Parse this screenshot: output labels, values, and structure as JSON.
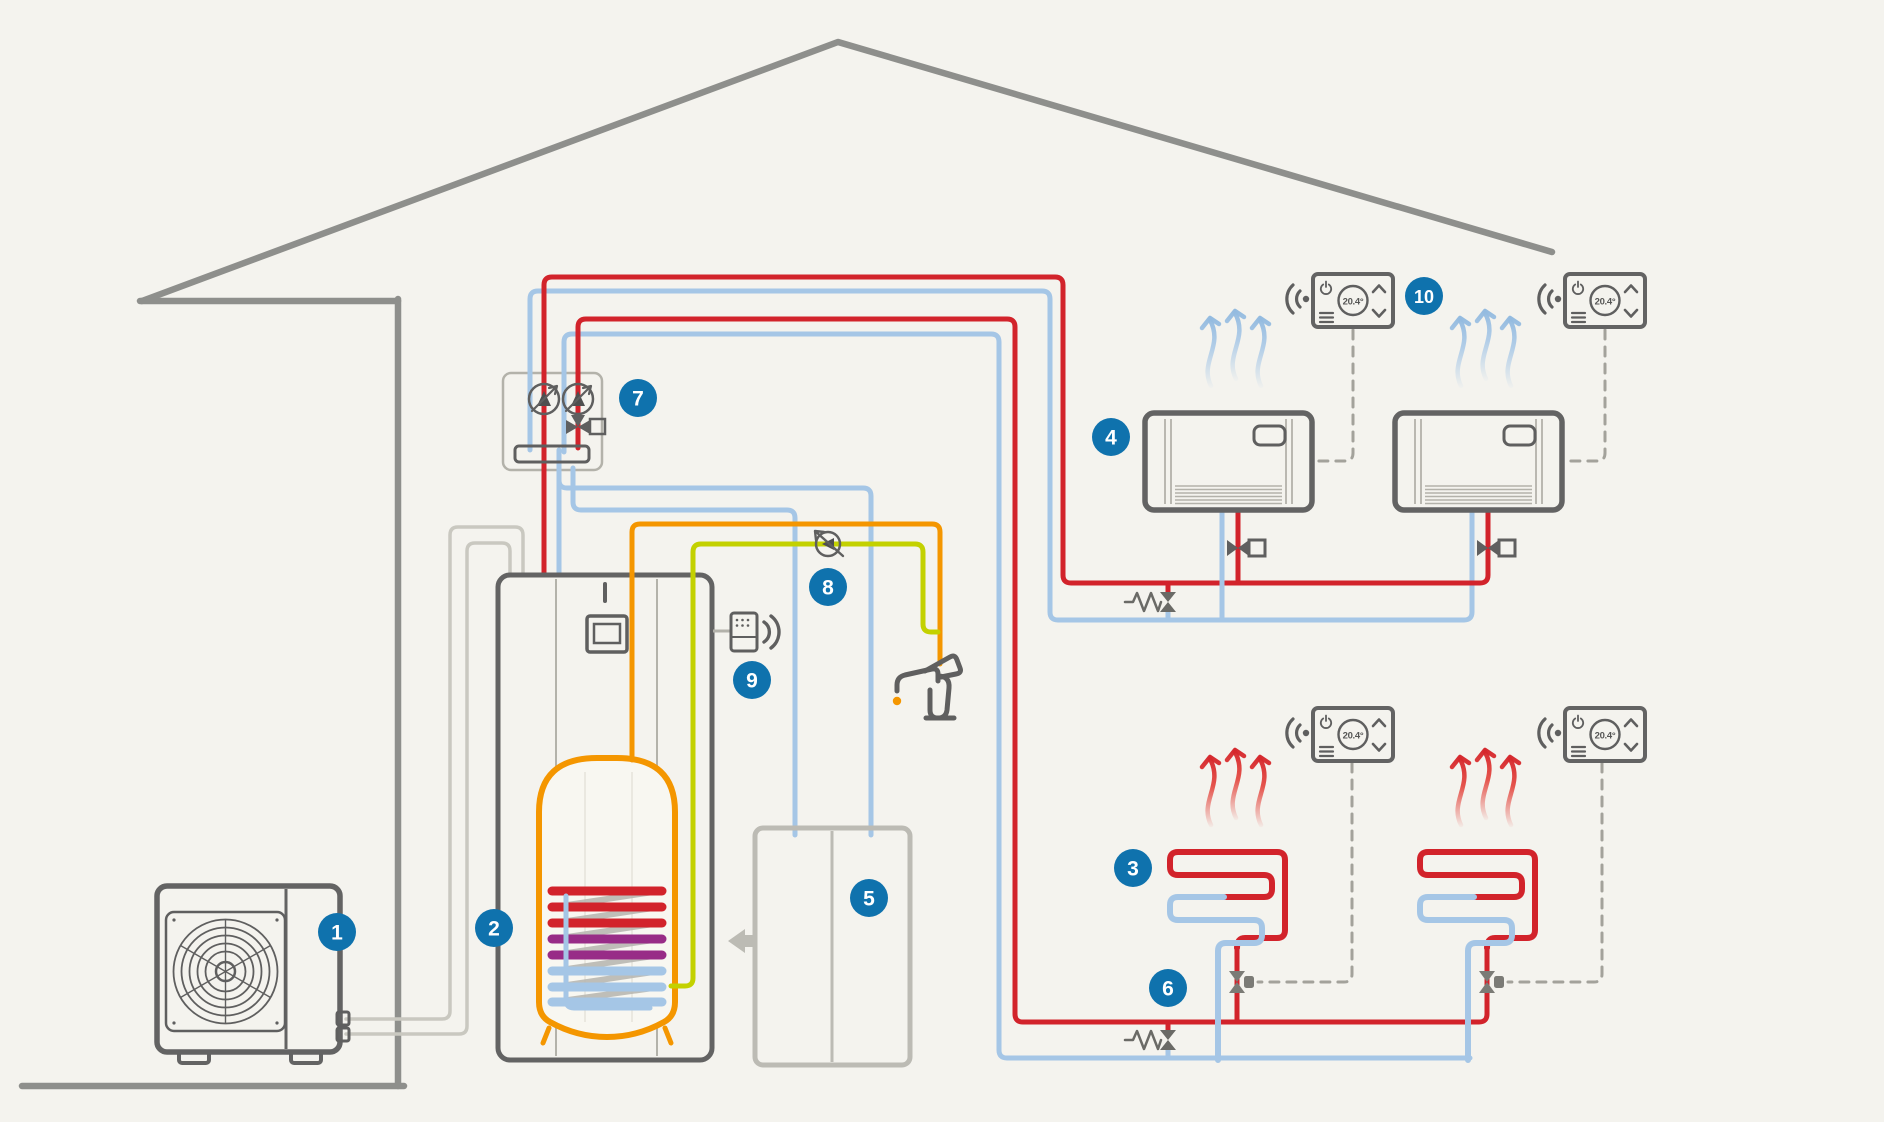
{
  "diagram_title": "Heat pump heating, cooling and hot water system schematic",
  "badges": [
    {
      "label": "1"
    },
    {
      "label": "2"
    },
    {
      "label": "3"
    },
    {
      "label": "4"
    },
    {
      "label": "5"
    },
    {
      "label": "6"
    },
    {
      "label": "7"
    },
    {
      "label": "8"
    },
    {
      "label": "9"
    },
    {
      "label": "10"
    }
  ],
  "thermostat": {
    "temperature_display": "20.4°"
  },
  "icons": {
    "thermostat_power": "power-icon",
    "thermostat_menu": "menu-icon",
    "thermostat_up": "chevron-up-icon",
    "thermostat_down": "chevron-down-icon",
    "thermostat_wireless": "wifi-icon",
    "gateway_wireless": "wifi-icon",
    "fan": "fan-icon",
    "tap": "tap-icon",
    "drip": "water-drop-icon",
    "air_warm": "warm-air-arrows-icon",
    "air_cool": "cool-air-arrows-icon",
    "cabinet_arrow": "arrow-left-icon"
  },
  "colors": {
    "bg": "#f4f3ee",
    "outline": "#636363",
    "outline-dark": "#5f5f5f",
    "roof": "#8e8f8c",
    "pipe-red": "#d2232b",
    "pipe-blue": "#a5c6e6",
    "pipe-orange": "#f49600",
    "pipe-green": "#c3d100",
    "coil-purple": "#982c87",
    "pipe-gray": "#c9c8c0",
    "light-gray": "#bcbbb4",
    "diag-gray": "#b9b8b2",
    "dash": "#a3a29b",
    "badge": "#0f72ad",
    "panel-line": "#b3b2aa",
    "white": "#ffffff"
  }
}
